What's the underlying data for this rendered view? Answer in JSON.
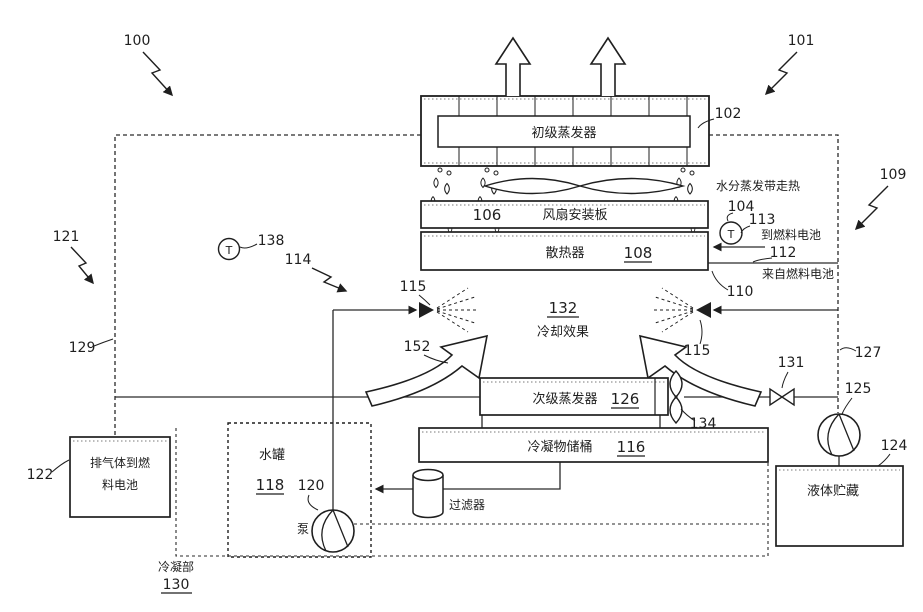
{
  "figure_refs": {
    "r100": "100",
    "r101": "101",
    "r102": "102",
    "r104": "104",
    "r106": "106",
    "r108": "108",
    "r109": "109",
    "r110": "110",
    "r112": "112",
    "r113": "113",
    "r114": "114",
    "r115_left": "115",
    "r115_right": "115",
    "r116": "116",
    "r118": "118",
    "r120": "120",
    "r121": "121",
    "r122": "122",
    "r124": "124",
    "r125": "125",
    "r126": "126",
    "r127": "127",
    "r129": "129",
    "r130": "130",
    "r131": "131",
    "r132": "132",
    "r134": "134",
    "r138": "138",
    "r152": "152"
  },
  "labels": {
    "primary_evaporator": "初级蒸发器",
    "fan_plate": "风扇安装板",
    "radiator": "散热器",
    "secondary_evaporator": "次级蒸发器",
    "condensate_tank": "冷凝物储桶",
    "water_tank": "水罐",
    "pump": "泵",
    "filter": "过滤器",
    "exhaust_box_line1": "排气体到燃",
    "exhaust_box_line2": "料电池",
    "liquid_storage": "液体贮藏",
    "condenser_section": "冷凝部",
    "cooling_effect": "冷却效果",
    "water_evaporation_note": "水分蒸发带走热",
    "to_fuel_cell": "到燃料电池",
    "from_fuel_cell": "来自燃料电池",
    "temp_sensor_glyph": "T"
  },
  "colors": {
    "line": "#1f1f1f",
    "background": "#ffffff"
  }
}
